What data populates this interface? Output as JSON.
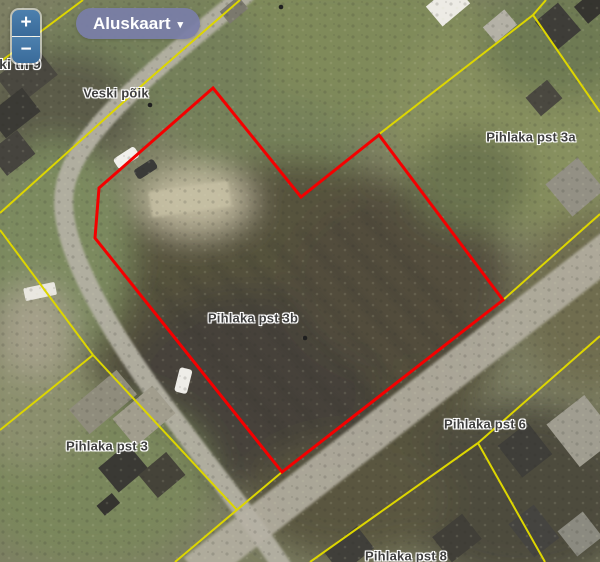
{
  "controls": {
    "zoom_in_label": "+",
    "zoom_out_label": "−",
    "basemap_label": "Aluskaart",
    "basemap_caret": "▾"
  },
  "colors": {
    "selected_parcel_outline": "#f40000",
    "cadastral_boundary": "#ddd600",
    "basemap_button_bg": "#7a7ea8",
    "zoom_button_bg": "#4377a6",
    "map_label_text": "#3e3e3e"
  },
  "map_labels": [
    {
      "name": "street-label-ki-tn-9",
      "text": "ki tn 9",
      "x": 20,
      "y": 64,
      "size": 14
    },
    {
      "name": "street-label-veski-poik",
      "text": "Veski põik",
      "x": 116,
      "y": 93,
      "size": 13
    },
    {
      "name": "parcel-label-pihlaka-pst-3a",
      "text": "Pihlaka pst 3a",
      "x": 531,
      "y": 137,
      "size": 13
    },
    {
      "name": "parcel-label-pihlaka-pst-3b",
      "text": "Pihlaka pst 3b",
      "x": 253,
      "y": 318,
      "size": 13
    },
    {
      "name": "parcel-label-pihlaka-pst-3",
      "text": "Pihlaka pst 3",
      "x": 107,
      "y": 446,
      "size": 13
    },
    {
      "name": "parcel-label-pihlaka-pst-6",
      "text": "Pihlaka pst 6",
      "x": 485,
      "y": 424,
      "size": 13
    },
    {
      "name": "parcel-label-pihlaka-pst-8",
      "text": "Pihlaka pst 8",
      "x": 406,
      "y": 556,
      "size": 13
    }
  ],
  "geometry": {
    "selected_parcel_points": [
      [
        213,
        88
      ],
      [
        301,
        197
      ],
      [
        379,
        135
      ],
      [
        503,
        300
      ],
      [
        282,
        472
      ],
      [
        95,
        238
      ],
      [
        99,
        188
      ]
    ],
    "cadastral_lines": [
      [
        [
          240,
          0
        ],
        [
          148,
          80
        ],
        [
          0,
          213
        ]
      ],
      [
        [
          83,
          0
        ],
        [
          0,
          62
        ]
      ],
      [
        [
          546,
          0
        ],
        [
          533,
          15
        ],
        [
          378,
          135
        ]
      ],
      [
        [
          533,
          15
        ],
        [
          600,
          112
        ]
      ],
      [
        [
          503,
          300
        ],
        [
          600,
          214
        ]
      ],
      [
        [
          503,
          300
        ],
        [
          282,
          472
        ],
        [
          175,
          562
        ]
      ],
      [
        [
          0,
          230
        ],
        [
          93,
          355
        ]
      ],
      [
        [
          93,
          355
        ],
        [
          0,
          430
        ]
      ],
      [
        [
          93,
          355
        ],
        [
          237,
          510
        ]
      ],
      [
        [
          600,
          336
        ],
        [
          478,
          443
        ]
      ],
      [
        [
          478,
          443
        ],
        [
          310,
          562
        ]
      ],
      [
        [
          478,
          443
        ],
        [
          545,
          562
        ]
      ]
    ],
    "address_dots": [
      [
        150,
        105
      ],
      [
        305,
        338
      ],
      [
        281,
        7
      ]
    ]
  }
}
